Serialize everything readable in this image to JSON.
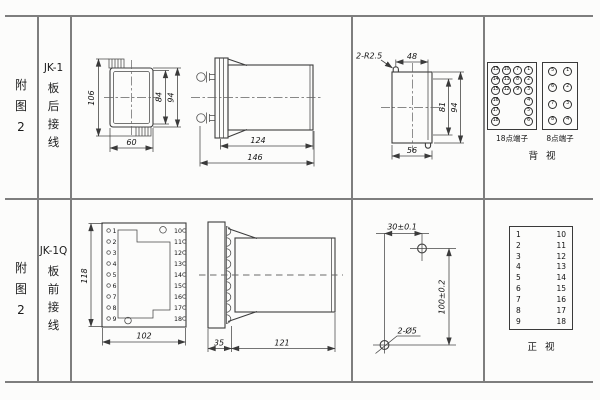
{
  "doc": {
    "rows": [
      {
        "figure": "附图2",
        "model": "JK-1",
        "wiring": "板后接线"
      },
      {
        "figure": "附图2",
        "model": "JK-1Q",
        "wiring": "板前接线"
      }
    ]
  },
  "top": {
    "rear_view": {
      "dim_height_total": "106",
      "dim_height_inner": "84",
      "dim_height_outer": "94",
      "dim_width": "60"
    },
    "side_view": {
      "dim_body": "124",
      "dim_total": "146"
    },
    "cutout": {
      "note_radius": "2-R2.5",
      "dim_hole_span": "48",
      "dim_inner_height": "81",
      "dim_outer_height": "94",
      "dim_width": "56"
    },
    "terminals18": {
      "label": "18点端子",
      "rows": [
        [
          "13",
          "10",
          "7",
          "1"
        ],
        [
          "14",
          "11",
          "8",
          "2"
        ],
        [
          "15",
          "12",
          "9",
          "3"
        ],
        [
          "16",
          "",
          "",
          "4"
        ],
        [
          "17",
          "",
          "",
          "5"
        ],
        [
          "18",
          "",
          "",
          "6"
        ]
      ]
    },
    "terminals8": {
      "label": "8点端子",
      "rows": [
        [
          "5",
          "1"
        ],
        [
          "6",
          "2"
        ],
        [
          "7",
          "3"
        ],
        [
          "8",
          "4"
        ]
      ]
    },
    "view_label": "背视"
  },
  "bottom": {
    "front_view": {
      "dim_height": "118",
      "dim_width": "102",
      "left_terminals": [
        "1",
        "2",
        "3",
        "4",
        "5",
        "6",
        "7",
        "8",
        "9"
      ],
      "right_terminals": [
        "10",
        "11",
        "12",
        "13",
        "14",
        "15",
        "16",
        "17",
        "18"
      ]
    },
    "side_view": {
      "dim_plate": "35",
      "dim_body": "121"
    },
    "drill_plan": {
      "dim_horizontal": "30±0.1",
      "dim_vertical": "100±0.2",
      "note_holes": "2-Ø5"
    },
    "front_table": {
      "left": [
        "1",
        "2",
        "3",
        "4",
        "5",
        "6",
        "7",
        "8",
        "9"
      ],
      "right": [
        "10",
        "11",
        "12",
        "13",
        "14",
        "15",
        "16",
        "17",
        "18"
      ],
      "view_label": "正视"
    }
  }
}
